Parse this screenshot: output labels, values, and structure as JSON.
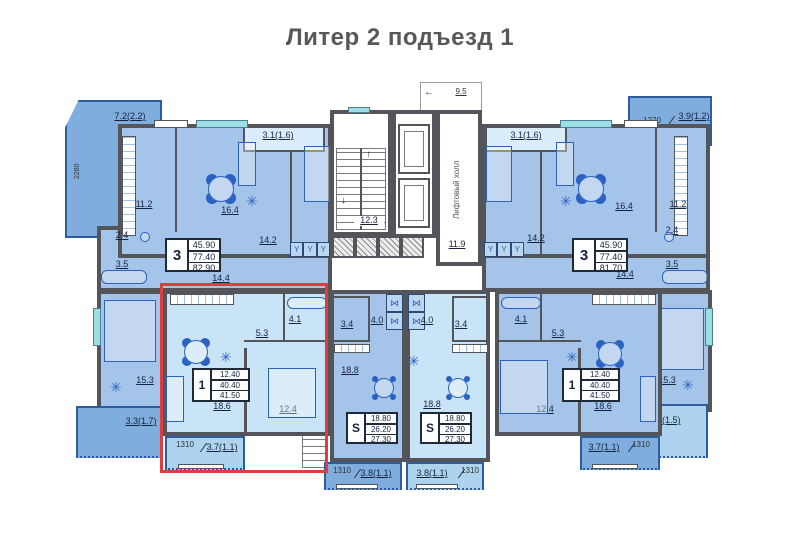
{
  "title": "Литер 2 подъезд 1",
  "icons": {
    "plant": "✳",
    "arrow_up": "↑",
    "arrow_down": "↓",
    "arrow_left": "←",
    "wardrobe": "Y",
    "closet": "⋈"
  },
  "core": {
    "stairs_area": "12.3",
    "elevator_hall_name": "Лифтовый холл",
    "elevator_hall_area": "11.9",
    "width_dim": "9.5"
  },
  "apartments": {
    "left3": {
      "stamp": {
        "rooms": "3",
        "living": "45.90",
        "usable": "77.40",
        "total": "82.90"
      },
      "kitchen": "11.2",
      "living_room": "16.4",
      "bedroom_front": "14.2",
      "hall": "14.4",
      "wc": "2.4",
      "bath": "3.5",
      "bedroom_side": "15.3",
      "balcony_top": "7.2(2.2)",
      "balcony_top_dim": "2280",
      "loggia": "3.1(1.6)",
      "balcony_side": "3.3(1.7)"
    },
    "right3": {
      "stamp": {
        "rooms": "3",
        "living": "45.90",
        "usable": "77.40",
        "total": "81.70"
      },
      "kitchen": "11.2",
      "living_room": "16.4",
      "bedroom_front": "14.2",
      "hall": "14.4",
      "wc": "2.4",
      "bath": "3.5",
      "bedroom_side": "15.3",
      "balcony_top": "3.9(1.2)",
      "balcony_top_dim": "1270",
      "loggia": "3.1(1.6)",
      "balcony_side": "3.0(1.5)"
    },
    "left1": {
      "stamp": {
        "rooms": "1",
        "living": "12.40",
        "usable": "40.40",
        "total": "41.50"
      },
      "kitchen_living": "18.6",
      "bedroom": "12.4",
      "hall": "5.3",
      "bath": "4.1",
      "balcony": "3.7(1.1)",
      "balcony_dim": "1310",
      "highlighted": true
    },
    "right1": {
      "stamp": {
        "rooms": "1",
        "living": "12.40",
        "usable": "40.40",
        "total": "41.50"
      },
      "kitchen_living": "18.6",
      "bedroom": "12.4",
      "hall": "5.3",
      "bath": "4.1",
      "balcony": "3.7(1.1)",
      "balcony_dim": "1310",
      "highlighted": false
    },
    "studio_left": {
      "stamp": {
        "rooms": "S",
        "living": "18.80",
        "usable": "26.20",
        "total": "27.30"
      },
      "main": "18.8",
      "hall": "4.0",
      "bath": "3.4",
      "balcony": "3.8(1.1)",
      "balcony_dim": "1310"
    },
    "studio_right": {
      "stamp": {
        "rooms": "S",
        "living": "18.80",
        "usable": "26.20",
        "total": "27.30"
      },
      "main": "18.8",
      "hall": "4.0",
      "bath": "3.4",
      "balcony": "3.8(1.1)",
      "balcony_dim": "1310"
    }
  },
  "colors": {
    "highlight_frame": "#e23b3b",
    "room_medium": "#a4c4e9",
    "room_light": "#c9e3f7",
    "balcony_medium": "#7fadde",
    "wall": "#54555a"
  }
}
